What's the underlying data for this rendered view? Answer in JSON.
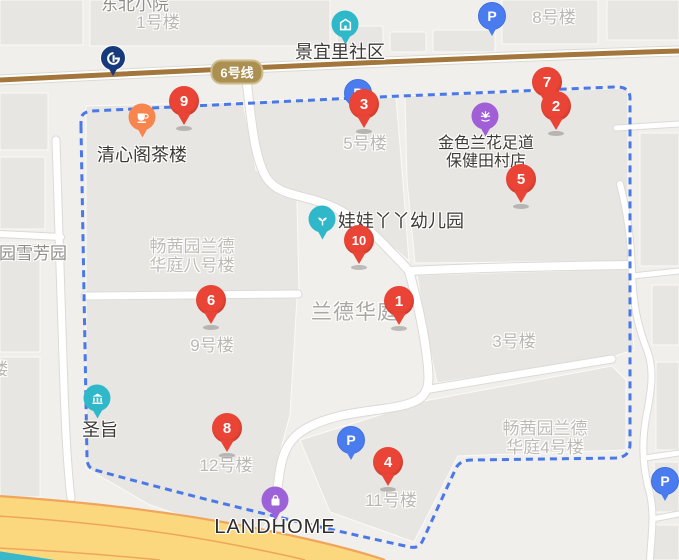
{
  "map": {
    "areas": {
      "dongbeixiaoyuan": "东北小院",
      "yuanxuefangyuan": "园雪芳园",
      "landehuating": "兰德华庭",
      "changxiyuan8_line1": "畅茜园兰德",
      "changxiyuan8_line2": "华庭八号楼",
      "changxiyuan4_line1": "畅茜园兰德",
      "changxiyuan4_line2": "华庭4号楼",
      "partial_lou": "楼"
    },
    "buildings": [
      "1号楼",
      "8号楼",
      "5号楼",
      "3号楼",
      "9号楼",
      "11号楼",
      "12号楼"
    ],
    "poi": {
      "community": {
        "label": "景宜里社区"
      },
      "teahouse": {
        "label": "清心阁茶楼"
      },
      "foot_massage": {
        "label_line1": "金色兰花足道",
        "label_line2": "保健田村店"
      },
      "kindergarten": {
        "label": "娃娃丫丫幼儿园"
      },
      "bank": {
        "label": "圣旨"
      },
      "mall": {
        "label": "LANDHOME"
      }
    },
    "subway": {
      "line_label": "6号线"
    },
    "parking": {
      "label": "P"
    },
    "markers": {
      "numbers": [
        "1",
        "2",
        "3",
        "4",
        "5",
        "6",
        "7",
        "8",
        "9",
        "10"
      ]
    },
    "colors": {
      "marker_red": "#e94436",
      "parking_blue": "#4a7cf0",
      "poi_teal": "#2fb8c9",
      "poi_orange": "#f9854e",
      "poi_purple": "#a05fd6",
      "boundary_blue": "#4a78e8",
      "metro_line_brown": "#a3763c",
      "metro_badge_tan": "#ac9052",
      "major_road_yellow": "#fbd87e",
      "major_road_edge_orange": "#f0a55c",
      "subway_logo_navy": "#173a7d"
    }
  }
}
